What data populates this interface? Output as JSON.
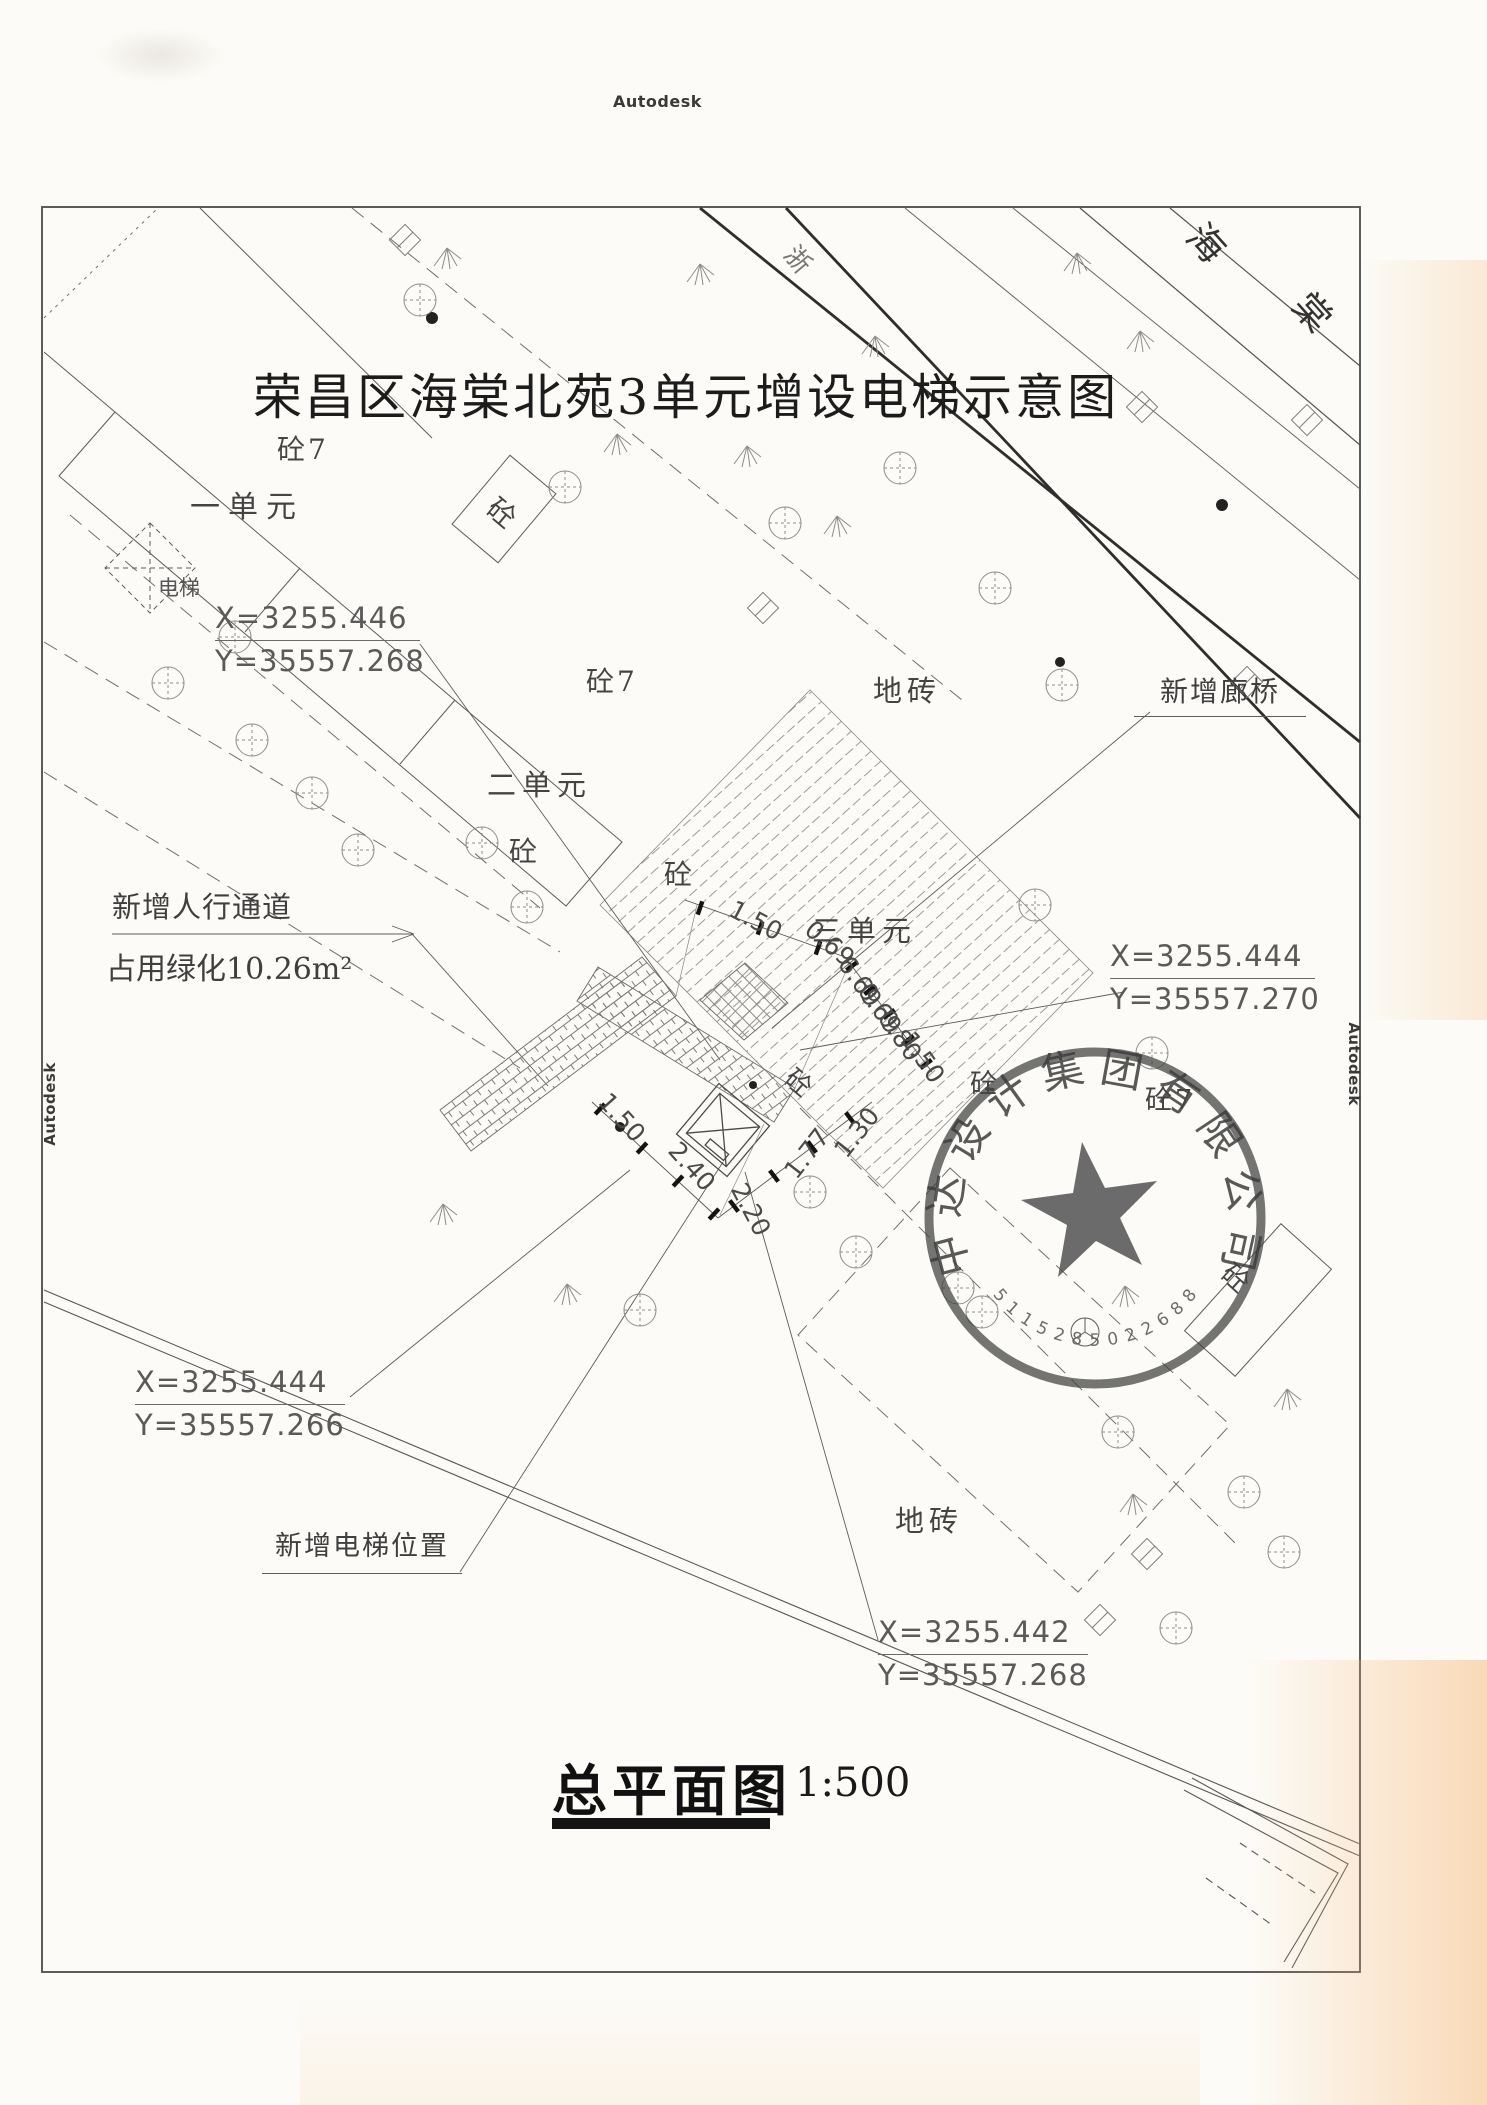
{
  "watermarks": {
    "top": "Autodesk",
    "left": "Autodesk",
    "right": "Autodesk"
  },
  "title": "荣昌区海棠北苑3单元增设电梯示意图",
  "street": {
    "char1": "海",
    "char2": "棠",
    "road_char": "浙"
  },
  "units": {
    "unit1": "一单元",
    "unit2": "二单元",
    "unit3": "三单元"
  },
  "materials": {
    "concrete": "砼",
    "concrete7": "砼7",
    "floor_tile": "地砖",
    "elevator": "电梯"
  },
  "callouts": {
    "coord_nw": {
      "x": "X=3255.446",
      "y": "Y=35557.268"
    },
    "coord_e": {
      "x": "X=3255.444",
      "y": "Y=35557.270"
    },
    "coord_sw": {
      "x": "X=3255.444",
      "y": "Y=35557.266"
    },
    "coord_se": {
      "x": "X=3255.442",
      "y": "Y=35557.268"
    },
    "new_corridor": "新增廊桥",
    "new_walkway": "新增人行通道",
    "green_area": "占用绿化10.26m²",
    "new_elevator": "新增电梯位置"
  },
  "dimensions": {
    "upper": [
      "1.50",
      "0.69",
      "6.69",
      "0.69",
      "0.80",
      "1.50"
    ],
    "lower": [
      "1.50",
      "2.40",
      "2.20",
      "1.77",
      "1.30"
    ]
  },
  "stamp": {
    "company": "中达设计集团有限公司",
    "serial": "5115285022688"
  },
  "footer": {
    "title": "总平面图",
    "scale": "1:500"
  },
  "colors": {
    "paper": "#fcfbf7",
    "ink": "#4a4a4a",
    "stamp": "#454545"
  }
}
